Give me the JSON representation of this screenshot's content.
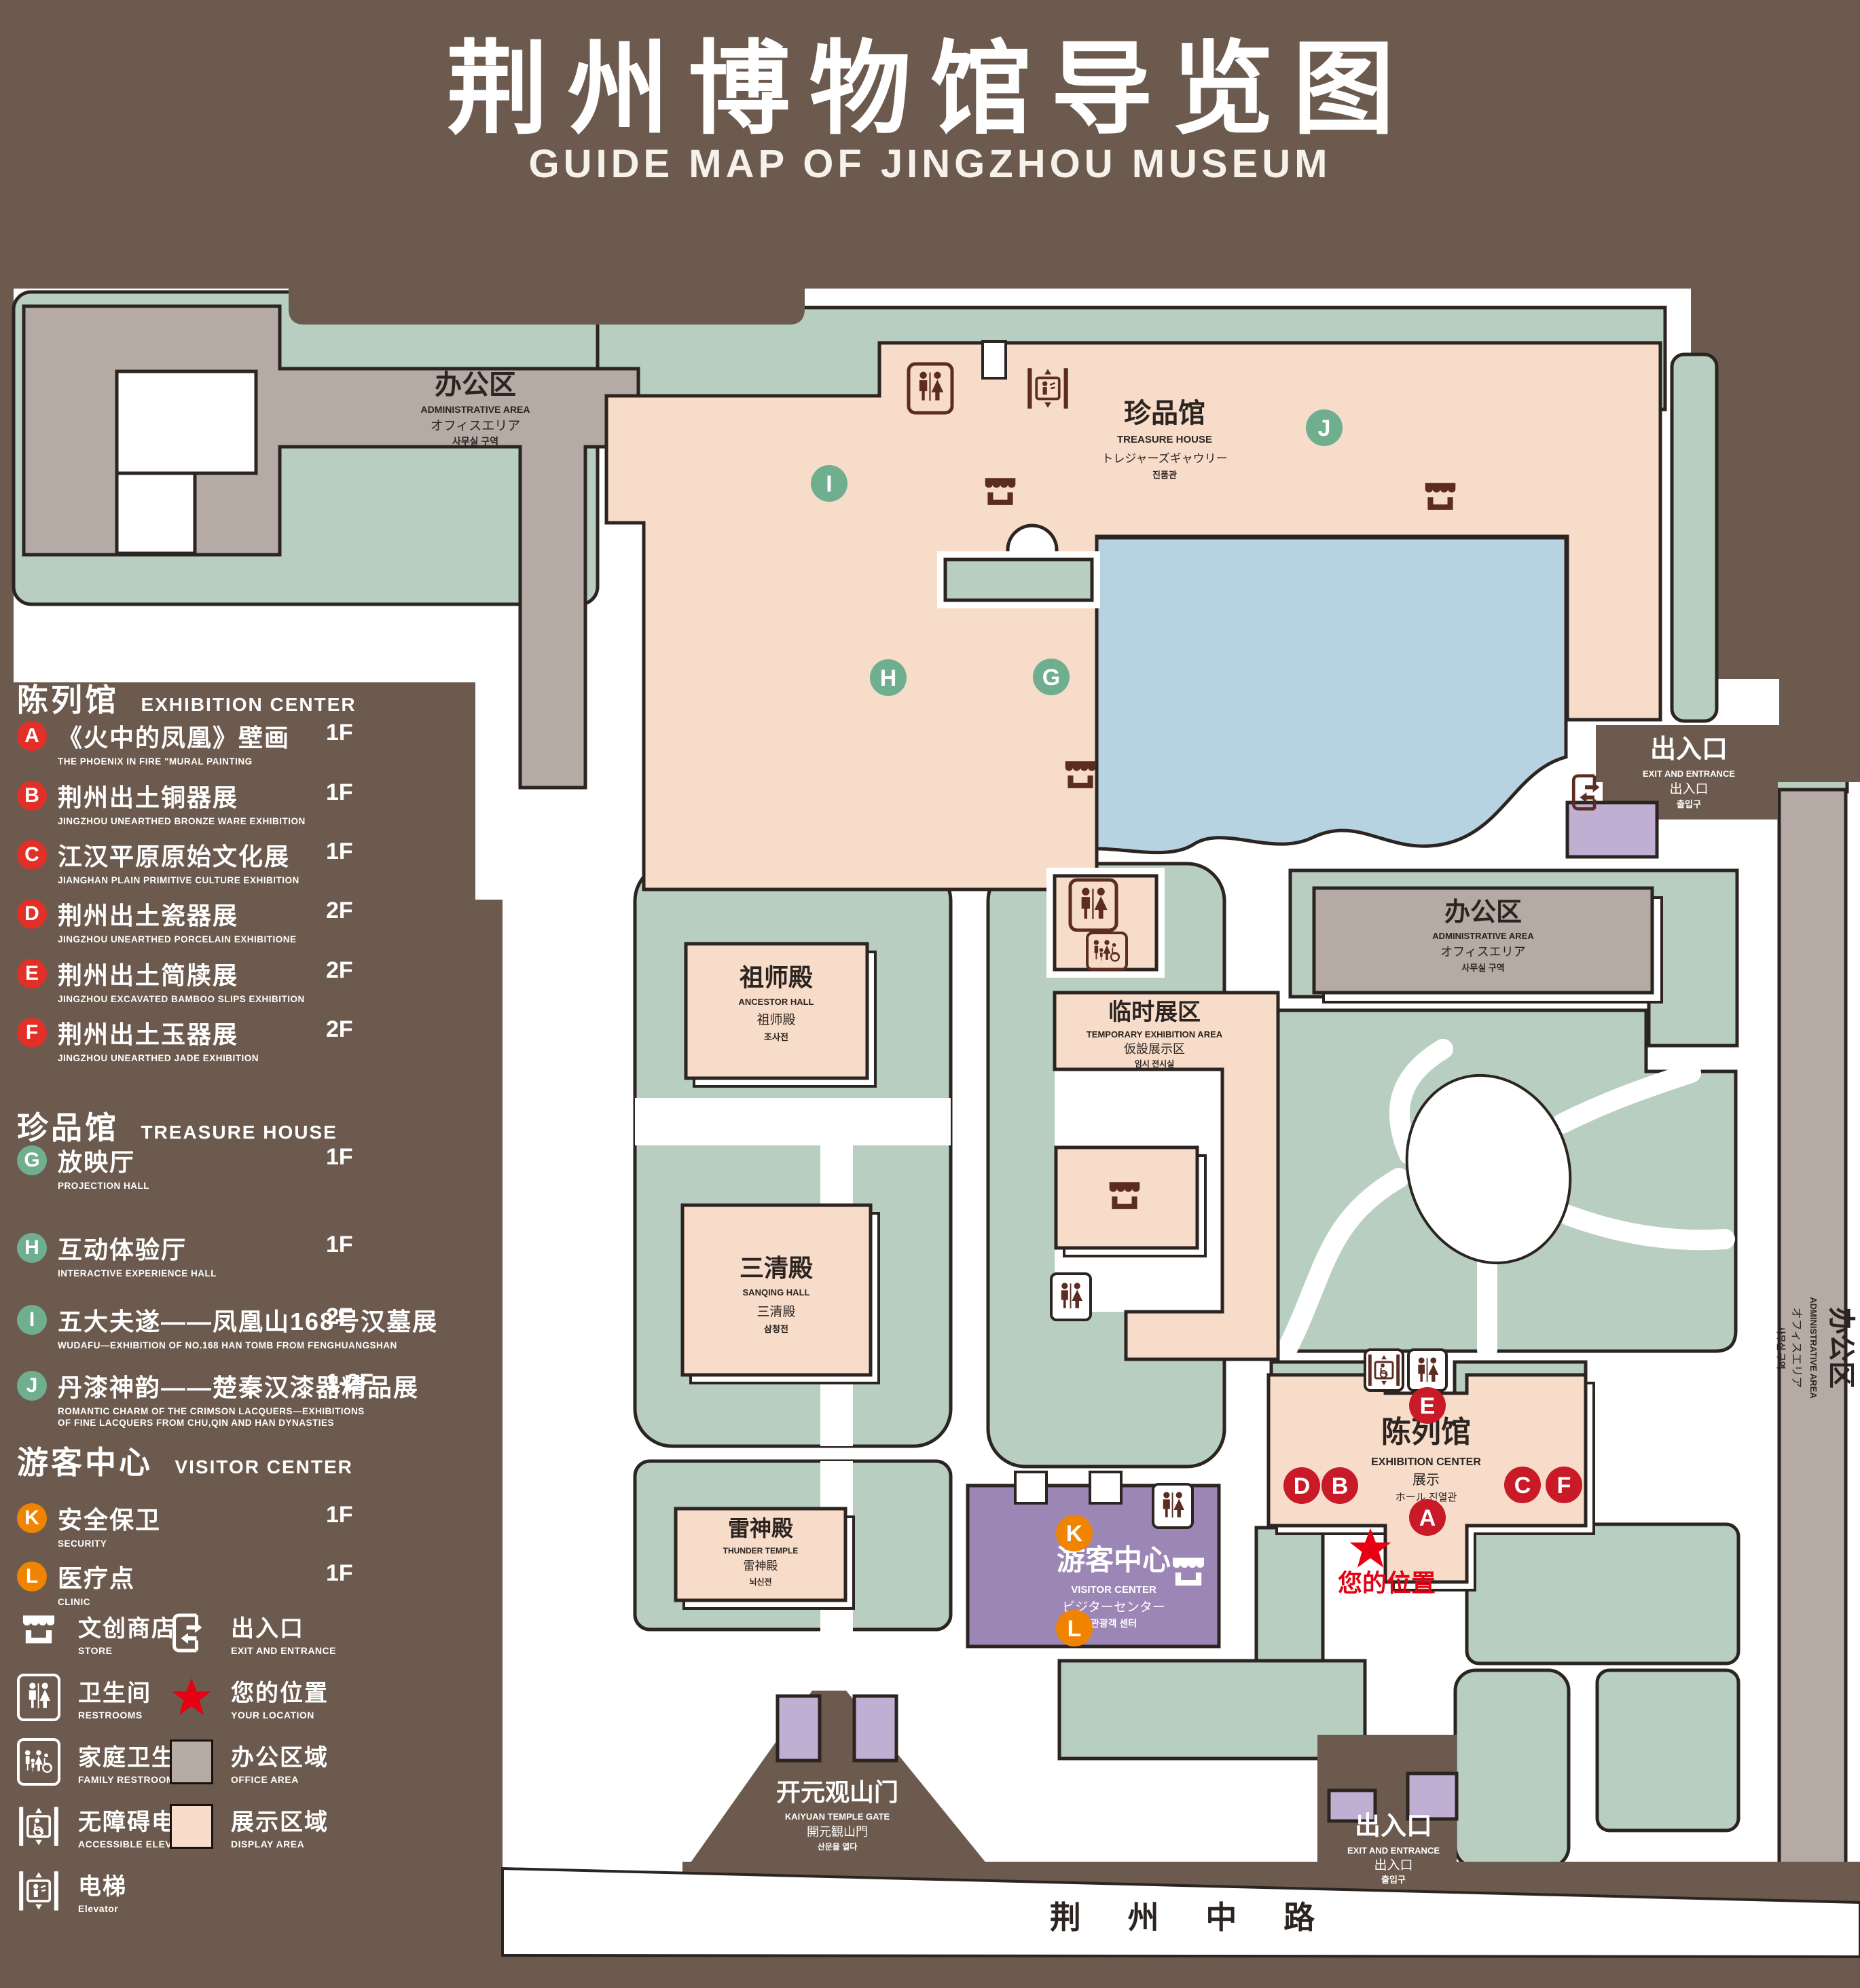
{
  "header": {
    "title_zh": "荆州博物馆导览图",
    "title_en": "GUIDE MAP OF JINGZHOU MUSEUM"
  },
  "legend": {
    "sections": [
      {
        "zh": "陈列馆",
        "en": "EXHIBITION CENTER",
        "items": [
          {
            "letter": "A",
            "zh": "《火中的凤凰》壁画",
            "en": "THE PHOENIX IN FIRE \"MURAL PAINTING",
            "floor": "1F"
          },
          {
            "letter": "B",
            "zh": "荆州出土铜器展",
            "en": "JINGZHOU UNEARTHED BRONZE WARE EXHIBITION",
            "floor": "1F"
          },
          {
            "letter": "C",
            "zh": "江汉平原原始文化展",
            "en": "JIANGHAN PLAIN PRIMITIVE CULTURE EXHIBITION",
            "floor": "1F"
          },
          {
            "letter": "D",
            "zh": "荆州出土瓷器展",
            "en": "JINGZHOU UNEARTHED PORCELAIN EXHIBITIONE",
            "floor": "2F"
          },
          {
            "letter": "E",
            "zh": "荆州出土简牍展",
            "en": "JINGZHOU EXCAVATED BAMBOO SLIPS EXHIBITION",
            "floor": "2F"
          },
          {
            "letter": "F",
            "zh": "荆州出土玉器展",
            "en": "JINGZHOU UNEARTHED JADE EXHIBITION",
            "floor": "2F"
          }
        ]
      },
      {
        "zh": "珍品馆",
        "en": "TREASURE HOUSE",
        "items": [
          {
            "letter": "G",
            "zh": "放映厅",
            "en": "PROJECTION HALL",
            "floor": "1F"
          },
          {
            "letter": "H",
            "zh": "互动体验厅",
            "en": "INTERACTIVE EXPERIENCE HALL",
            "floor": "1F"
          },
          {
            "letter": "I",
            "zh": "五大夫遂——凤凰山168号汉墓展",
            "en": "WUDAFU—EXHIBITION OF NO.168 HAN TOMB FROM FENGHUANGSHAN",
            "floor": "2F"
          },
          {
            "letter": "J",
            "zh": "丹漆神韵——楚秦汉漆器精品展",
            "en": "ROMANTIC CHARM OF THE CRIMSON LACQUERS—EXHIBITIONS",
            "en2": "OF FINE LACQUERS FROM CHU,QIN AND HAN DYNASTIES",
            "floor": "1-2F"
          }
        ]
      },
      {
        "zh": "游客中心",
        "en": "VISITOR CENTER",
        "items": [
          {
            "letter": "K",
            "zh": "安全保卫",
            "en": "SECURITY",
            "floor": "1F"
          },
          {
            "letter": "L",
            "zh": "医疗点",
            "en": "CLINIC",
            "floor": "1F"
          }
        ]
      }
    ],
    "icon_rows_left": [
      {
        "icon": "store-icon",
        "zh": "文创商店",
        "en": "STORE"
      },
      {
        "icon": "restroom-icon",
        "zh": "卫生间",
        "en": "RESTROOMS"
      },
      {
        "icon": "family-restroom-icon",
        "zh": "家庭卫生间",
        "en": "FAMILY RESTROOMS"
      },
      {
        "icon": "accessible-elevator-icon",
        "zh": "无障碍电梯",
        "en": "ACCESSIBLE ELEVATOR"
      },
      {
        "icon": "elevator-icon",
        "zh": "电梯",
        "en": "Elevator"
      }
    ],
    "icon_rows_right": [
      {
        "icon": "exit-icon",
        "zh": "出入口",
        "en": "EXIT AND ENTRANCE"
      },
      {
        "icon": "location-star-icon",
        "zh": "您的位置",
        "en": "YOUR LOCATION"
      },
      {
        "icon": "office-area-swatch",
        "zh": "办公区域",
        "en": "OFFICE AREA"
      },
      {
        "icon": "display-area-swatch",
        "zh": "展示区域",
        "en": "DISPLAY AREA"
      }
    ]
  },
  "map": {
    "buildings": {
      "admin_nw": {
        "zh": "办公区",
        "en": "ADMINISTRATIVE AREA",
        "ja": "オフィスエリア",
        "ko": "사무실 구역"
      },
      "treasure": {
        "zh": "珍品馆",
        "en": "TREASURE HOUSE",
        "ja": "トレジャーズギャウリー",
        "ko": "진품관"
      },
      "admin_e": {
        "zh": "办公区",
        "en": "ADMINISTRATIVE AREA",
        "ja": "オフィスエリア",
        "ko": "사무실 구역"
      },
      "admin_strip": {
        "zh": "办公区",
        "en": "ADMINISTRATIVE AREA",
        "ja": "オフィスエリア",
        "ko": "사무실 구역"
      },
      "ancestor": {
        "zh": "祖师殿",
        "en": "ANCESTOR HALL",
        "ja": "祖师殿",
        "ko": "조사전"
      },
      "sanqing": {
        "zh": "三清殿",
        "en": "SANQING HALL",
        "ja": "三清殿",
        "ko": "삼청전"
      },
      "thunder": {
        "zh": "雷神殿",
        "en": "THUNDER TEMPLE",
        "ja": "雷神殿",
        "ko": "뇌신전"
      },
      "temporary": {
        "zh": "临时展区",
        "en": "TEMPORARY EXHIBITION AREA",
        "ja": "仮設展示区",
        "ko": "임시 전시실"
      },
      "exhibition": {
        "zh": "陈列馆",
        "en": "EXHIBITION CENTER",
        "ja": "展示",
        "ko": "ホール 진열관"
      },
      "visitor": {
        "zh": "游客中心",
        "en": "VISITOR CENTER",
        "ja": "ビジターセンター",
        "ko": "관광객 센터"
      },
      "gate": {
        "zh": "开元观山门",
        "en": "KAIYUAN TEMPLE GATE",
        "ja": "開元観山門",
        "ko": "산문을 열다"
      }
    },
    "exit_ne": {
      "zh": "出入口",
      "en": "EXIT AND ENTRANCE",
      "ja": "出入口",
      "ko": "출입구"
    },
    "exit_s": {
      "zh": "出入口",
      "en": "EXIT AND ENTRANCE",
      "ja": "出入口",
      "ko": "출입구"
    },
    "road": "荆 州 中 路",
    "your_location": "您的位置",
    "markers": {
      "A": "A",
      "B": "B",
      "C": "C",
      "D": "D",
      "E": "E",
      "F": "F",
      "G": "G",
      "H": "H",
      "I": "I",
      "J": "J",
      "K": "K",
      "L": "L"
    }
  },
  "colors": {
    "background": "#6b5a4d",
    "green_area": "#b7cec0",
    "display_area": "#f8dcca",
    "office_area": "#b5aba4",
    "water": "#b7d3e2",
    "visitor_purple": "#9c86b6",
    "light_purple": "#c0afd2",
    "marker_red": "#c91a28",
    "marker_green": "#6fae8e",
    "marker_orange": "#f08300",
    "icon_brown": "#5c2c22",
    "star_red": "#e60012"
  }
}
